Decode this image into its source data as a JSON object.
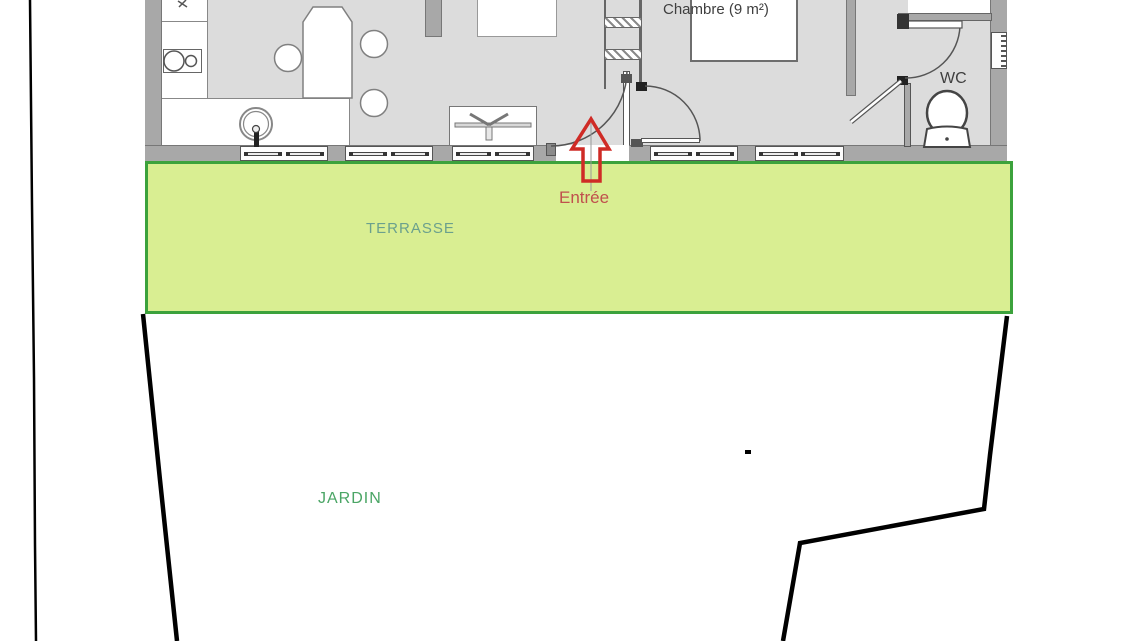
{
  "title": "Plan de maison avec terrasse et jardin",
  "labels": {
    "chambre": "Chambre (9 m²)",
    "wc": "WC",
    "entree": "Entrée",
    "terrasse": "TERRASSE",
    "jardin": "JARDIN"
  },
  "colors": {
    "terrasse_fill": "#d9ee92",
    "terrasse_border": "#3ca23c",
    "terrasse_label": "#6ba08d",
    "jardin_label": "#4aa565",
    "entree_label": "#c0504d",
    "entree_arrow": "#cf2b26",
    "wall": "#a8a8a8",
    "wall_outline": "#6f6f6f",
    "floor": "#dcdcdc",
    "room_label": "#3f3f3f",
    "boundary": "#000000"
  }
}
